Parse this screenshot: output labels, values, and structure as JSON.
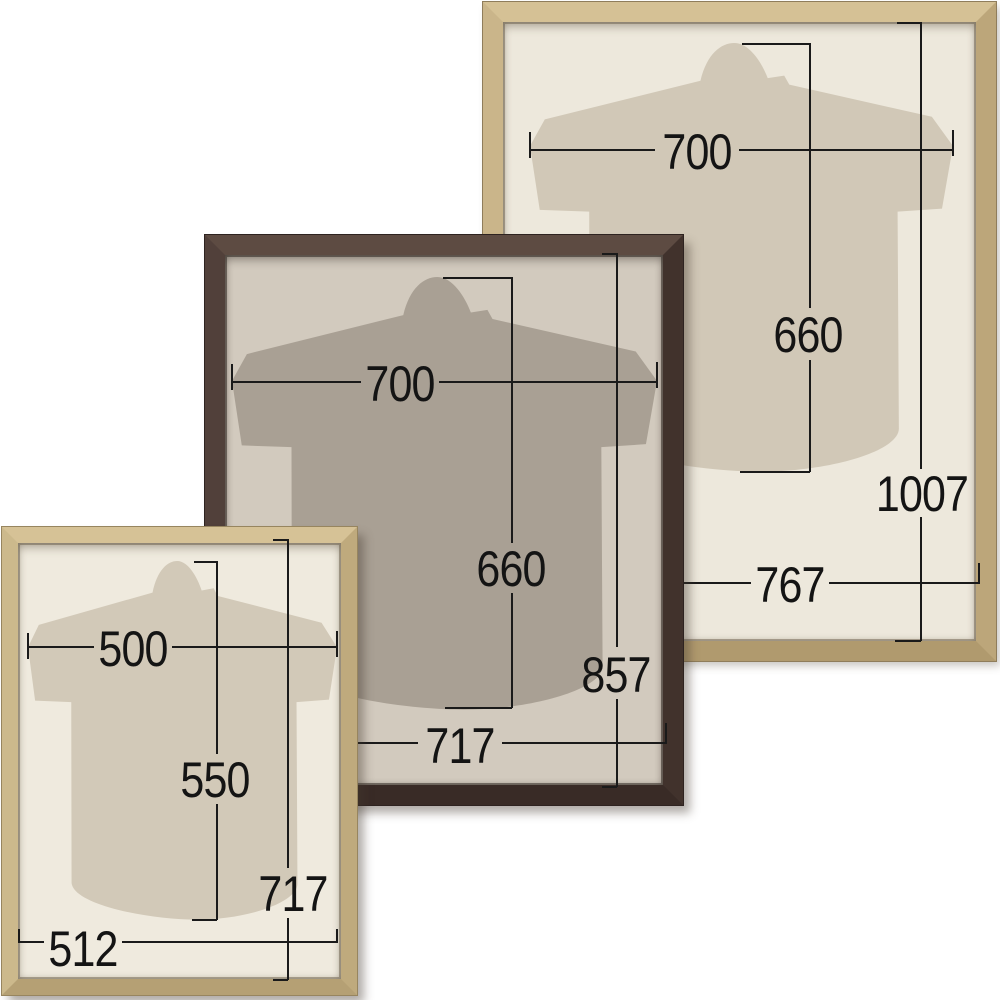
{
  "diagram": {
    "description": "Three wooden shirt display frames with millimetre dimension callouts",
    "background_color": "#ffffff",
    "dimension_line_color": "#1a1a1a",
    "frames": [
      {
        "name": "large-natural-wood-frame",
        "wood_color": "#c9b488",
        "mat_color": "#ede8dc",
        "shirt_color": "#d1c8b7",
        "dims": {
          "shirt_width": "700",
          "shirt_height": "660",
          "frame_height": "1007",
          "frame_width": "767"
        }
      },
      {
        "name": "medium-dark-brown-frame",
        "wood_color": "#4a3a33",
        "mat_color": "#d2cabe",
        "shirt_color": "#a9a094",
        "dims": {
          "shirt_width": "700",
          "shirt_height": "660",
          "frame_height": "857",
          "frame_width": "717"
        }
      },
      {
        "name": "small-natural-wood-frame",
        "wood_color": "#cbb88b",
        "mat_color": "#efeade",
        "shirt_color": "#d2c9b8",
        "dims": {
          "shirt_width": "500",
          "shirt_height": "550",
          "frame_height": "717",
          "frame_width": "512"
        }
      }
    ]
  }
}
